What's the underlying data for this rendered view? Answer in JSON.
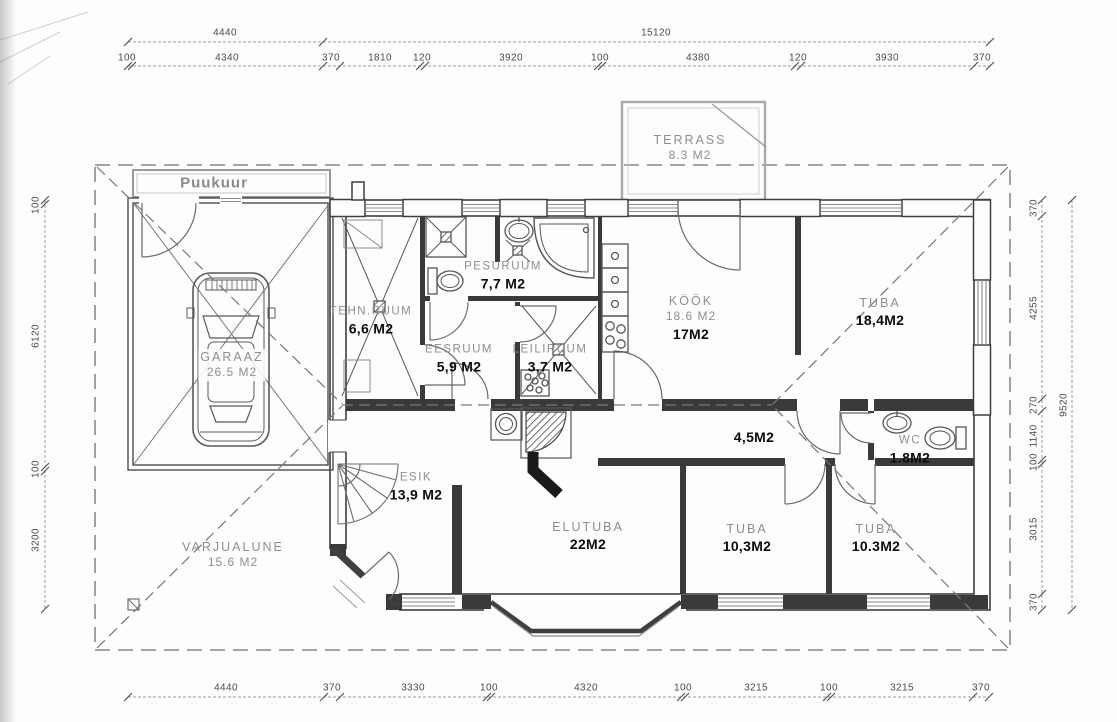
{
  "plan": {
    "shed": {
      "label": "Puukuur"
    },
    "terrace": {
      "name": "TERRASS",
      "area": "8.3 M2"
    },
    "rooms": {
      "garaaz": {
        "name": "GARAAZ",
        "area": "26.5 M2"
      },
      "tehnruum": {
        "name": "TEHN.RUUM",
        "marker": "6,6 M2"
      },
      "pesuruum": {
        "name": "PESURUUM",
        "marker": "7,7 M2"
      },
      "eesruum": {
        "name": "EESRUUM",
        "marker": "5,9 M2"
      },
      "leiliruum": {
        "name": "LEILIRUUM",
        "marker": "3,7 M2"
      },
      "kook": {
        "name": "KÖÖK",
        "area": "18.6 M2",
        "marker": "17M2"
      },
      "tuba_ne": {
        "name": "TUBA",
        "marker": "18,4M2"
      },
      "koridor": {
        "marker": "4,5M2"
      },
      "wc": {
        "name": "WC",
        "marker": "1.8M2"
      },
      "esik": {
        "name": "ESIK",
        "marker": "13,9 M2"
      },
      "elutuba": {
        "name": "ELUTUBA",
        "marker": "22M2"
      },
      "tuba_s": {
        "name": "TUBA",
        "marker": "10,3M2"
      },
      "tuba_se": {
        "name": "TUBA",
        "marker": "10.3M2"
      },
      "varjualune": {
        "name": "VARJUALUNE",
        "area": "15.6 M2"
      }
    },
    "dims": {
      "top_overall": [
        "4440",
        "15120"
      ],
      "top_detail": [
        "100",
        "4340",
        "370",
        "1810",
        "120",
        "3920",
        "100",
        "4380",
        "120",
        "3930",
        "370"
      ],
      "bottom": [
        "4440",
        "370",
        "3330",
        "100",
        "4320",
        "100",
        "3215",
        "100",
        "3215",
        "370"
      ],
      "left": [
        "100",
        "6120",
        "100",
        "3200"
      ],
      "right": [
        "370",
        "4255",
        "270",
        "1140",
        "100",
        "3015",
        "370"
      ],
      "right_overall": "9520"
    },
    "colors": {
      "wall": "#3f3f3f",
      "label_gray": "#8f8f8f",
      "marker_black": "#0c0c0c"
    }
  }
}
